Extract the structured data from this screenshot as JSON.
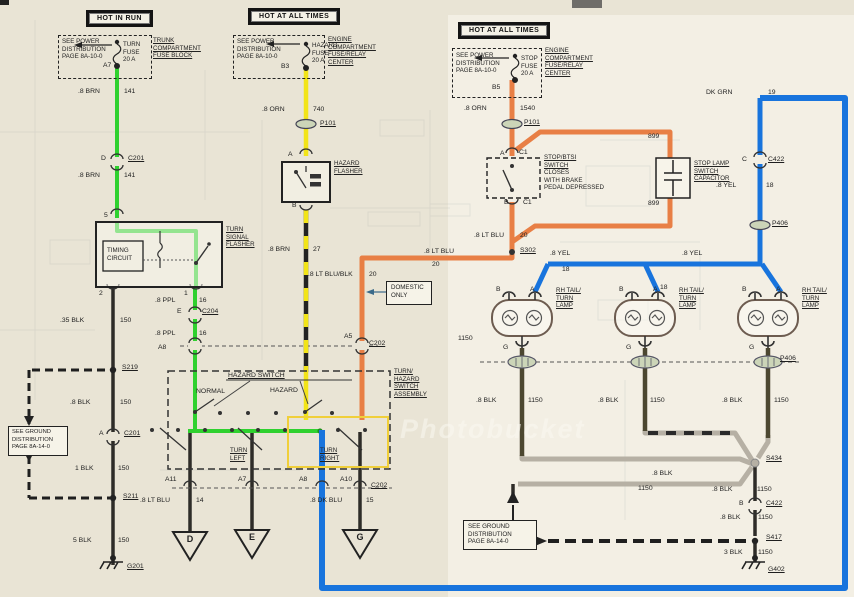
{
  "colors": {
    "green": "#2fd12f",
    "yellow": "#f2e418",
    "orange": "#e87f45",
    "blue": "#1874dd",
    "gray_bus": "#b6b0a4",
    "paper": "#e9e4d5",
    "paper_right": "#f3efe4",
    "wire_dark": "#2e2c28",
    "olive": "#4c4730"
  },
  "watermark": "Photobucket",
  "feeds": [
    {
      "banner": "HOT IN RUN",
      "note": [
        "SEE POWER",
        "DISTRIBUTION",
        "PAGE 8A-10-0"
      ],
      "fuse": [
        "TURN",
        "FUSE",
        "20 A"
      ],
      "loc": [
        "TRUNK",
        "COMPARTMENT",
        "FUSE BLOCK"
      ]
    },
    {
      "banner": "HOT AT ALL TIMES",
      "note": [
        "SEE POWER",
        "DISTRIBUTION",
        "PAGE 8A-10-0"
      ],
      "fuse": [
        "HAZARD",
        "FUSE",
        "20 A"
      ],
      "loc": [
        "ENGINE",
        "COMPARTMENT",
        "FUSE/RELAY",
        "CENTER"
      ]
    },
    {
      "banner": "HOT AT ALL TIMES",
      "note": [
        "SEE POWER",
        "DISTRIBUTION",
        "PAGE 8A-10-0"
      ],
      "fuse": [
        "STOP",
        "FUSE",
        "20 A"
      ],
      "loc": [
        "ENGINE",
        "COMPARTMENT",
        "FUSE/RELAY",
        "CENTER"
      ]
    }
  ],
  "components": {
    "turn_flasher": {
      "name": [
        "TURN",
        "SIGNAL",
        "FLASHER"
      ],
      "timing": [
        "TIMING",
        "CIRCUIT"
      ]
    },
    "hazard_flasher": {
      "name": [
        "HAZARD",
        "FLASHER"
      ]
    },
    "stop_switch": {
      "title": [
        "STOP/BTSI",
        "SWITCH"
      ],
      "desc": [
        "CLOSES",
        "WITH BRAKE",
        "PEDAL DEPRESSED"
      ]
    },
    "capacitor": {
      "name": [
        "STOP LAMP",
        "SWITCH",
        "CAPACITOR"
      ]
    },
    "switch_assembly": {
      "hazard_switch": "HAZARD SWITCH",
      "normal": "NORMAL",
      "hazard": "HAZARD",
      "turn_left": [
        "TURN",
        "LEFT"
      ],
      "turn_right": [
        "TURN",
        "RIGHT"
      ],
      "name": [
        "TURN/",
        "HAZARD",
        "SWITCH",
        "ASSEMBLY"
      ]
    },
    "domestic_note": [
      "DOMESTIC",
      "ONLY"
    ],
    "ground_ref_left": [
      "SEE GROUND",
      "DISTRIBUTION",
      "PAGE 8A-14-0"
    ],
    "ground_ref_mid": [
      "SEE GROUND",
      "DISTRIBUTION",
      "PAGE 8A-14-0"
    ],
    "lamp": {
      "name": [
        "RH TAIL/",
        "TURN",
        "LAMP"
      ]
    }
  },
  "connector_triangles": [
    "D",
    "E",
    "G"
  ],
  "labels": [
    {
      "t": ".8 BRN",
      "x": 78,
      "y": 88
    },
    {
      "t": "141",
      "x": 124,
      "y": 88
    },
    {
      "t": "A7",
      "x": 103,
      "y": 62
    },
    {
      "t": "D",
      "x": 101,
      "y": 155
    },
    {
      "t": "C201",
      "x": 128,
      "y": 155,
      "u": 1
    },
    {
      "t": ".8 BRN",
      "x": 78,
      "y": 172
    },
    {
      "t": "141",
      "x": 124,
      "y": 172
    },
    {
      "t": "5",
      "x": 104,
      "y": 212
    },
    {
      "t": "2",
      "x": 99,
      "y": 290
    },
    {
      "t": "1",
      "x": 184,
      "y": 290
    },
    {
      "t": ".35 BLK",
      "x": 60,
      "y": 317
    },
    {
      "t": "150",
      "x": 120,
      "y": 317
    },
    {
      "t": "S219",
      "x": 122,
      "y": 364,
      "u": 1
    },
    {
      "t": ".8 BLK",
      "x": 70,
      "y": 399
    },
    {
      "t": "150",
      "x": 120,
      "y": 399
    },
    {
      "t": "A",
      "x": 99,
      "y": 430
    },
    {
      "t": "C201",
      "x": 124,
      "y": 430,
      "u": 1
    },
    {
      "t": "1 BLK",
      "x": 75,
      "y": 465
    },
    {
      "t": "150",
      "x": 118,
      "y": 465
    },
    {
      "t": "S211",
      "x": 123,
      "y": 493,
      "u": 1
    },
    {
      "t": "5 BLK",
      "x": 73,
      "y": 537
    },
    {
      "t": "150",
      "x": 118,
      "y": 537
    },
    {
      "t": "G201",
      "x": 127,
      "y": 563,
      "u": 1
    },
    {
      "t": ".8 PPL",
      "x": 155,
      "y": 297
    },
    {
      "t": "16",
      "x": 199,
      "y": 297
    },
    {
      "t": "E",
      "x": 177,
      "y": 308
    },
    {
      "t": "C204",
      "x": 202,
      "y": 308,
      "u": 1
    },
    {
      "t": ".8 PPL",
      "x": 155,
      "y": 330
    },
    {
      "t": "16",
      "x": 199,
      "y": 330
    },
    {
      "t": "A8",
      "x": 158,
      "y": 344
    },
    {
      "t": "A5",
      "x": 344,
      "y": 333
    },
    {
      "t": "C202",
      "x": 369,
      "y": 340,
      "u": 1
    },
    {
      "t": "B3",
      "x": 281,
      "y": 63
    },
    {
      "t": ".8 ORN",
      "x": 262,
      "y": 106
    },
    {
      "t": "740",
      "x": 313,
      "y": 106
    },
    {
      "t": "P101",
      "x": 320,
      "y": 120,
      "u": 1
    },
    {
      "t": "A",
      "x": 288,
      "y": 151
    },
    {
      "t": "B",
      "x": 292,
      "y": 202
    },
    {
      "t": ".8 BRN",
      "x": 268,
      "y": 246
    },
    {
      "t": "27",
      "x": 313,
      "y": 246
    },
    {
      "t": ".8 LT BLU/BLK",
      "x": 308,
      "y": 271
    },
    {
      "t": "20",
      "x": 369,
      "y": 271
    },
    {
      "t": "B5",
      "x": 492,
      "y": 84
    },
    {
      "t": ".8 ORN",
      "x": 464,
      "y": 105
    },
    {
      "t": "1540",
      "x": 520,
      "y": 105
    },
    {
      "t": "P101",
      "x": 524,
      "y": 119,
      "u": 1
    },
    {
      "t": "A",
      "x": 500,
      "y": 150
    },
    {
      "t": "C1",
      "x": 519,
      "y": 149
    },
    {
      "t": "B",
      "x": 504,
      "y": 199
    },
    {
      "t": "C1",
      "x": 523,
      "y": 199
    },
    {
      "t": ".8 LT BLU",
      "x": 474,
      "y": 232
    },
    {
      "t": "20",
      "x": 520,
      "y": 232
    },
    {
      "t": "S302",
      "x": 520,
      "y": 247,
      "u": 1
    },
    {
      "t": ".8 LT BLU",
      "x": 424,
      "y": 248
    },
    {
      "t": "20",
      "x": 432,
      "y": 261
    },
    {
      "t": "899",
      "x": 648,
      "y": 133
    },
    {
      "t": "899",
      "x": 648,
      "y": 200
    },
    {
      "t": "DK GRN",
      "x": 706,
      "y": 89
    },
    {
      "t": "19",
      "x": 768,
      "y": 89
    },
    {
      "t": "C",
      "x": 742,
      "y": 156
    },
    {
      "t": "C422",
      "x": 768,
      "y": 156,
      "u": 1
    },
    {
      "t": ".8 YEL",
      "x": 716,
      "y": 182
    },
    {
      "t": "18",
      "x": 766,
      "y": 182
    },
    {
      "t": "P406",
      "x": 772,
      "y": 220,
      "u": 1
    },
    {
      "t": ".8 YEL",
      "x": 550,
      "y": 250
    },
    {
      "t": "18",
      "x": 562,
      "y": 266
    },
    {
      "t": ".8 YEL",
      "x": 682,
      "y": 250
    },
    {
      "t": "18",
      "x": 660,
      "y": 284
    },
    {
      "t": "1150",
      "x": 458,
      "y": 335
    },
    {
      "t": "B",
      "x": 496,
      "y": 286
    },
    {
      "t": "A",
      "x": 530,
      "y": 286
    },
    {
      "t": "G",
      "x": 503,
      "y": 344
    },
    {
      "t": "B",
      "x": 619,
      "y": 286
    },
    {
      "t": "A",
      "x": 653,
      "y": 286
    },
    {
      "t": "G",
      "x": 626,
      "y": 344
    },
    {
      "t": "B",
      "x": 742,
      "y": 286
    },
    {
      "t": "A",
      "x": 776,
      "y": 286
    },
    {
      "t": "G",
      "x": 749,
      "y": 344
    },
    {
      "t": "P406",
      "x": 780,
      "y": 355,
      "u": 1
    },
    {
      "t": ".8 BLK",
      "x": 476,
      "y": 397
    },
    {
      "t": "1150",
      "x": 528,
      "y": 397
    },
    {
      "t": ".8 BLK",
      "x": 598,
      "y": 397
    },
    {
      "t": "1150",
      "x": 650,
      "y": 397
    },
    {
      "t": ".8 BLK",
      "x": 722,
      "y": 397
    },
    {
      "t": "1150",
      "x": 774,
      "y": 397
    },
    {
      "t": "S434",
      "x": 766,
      "y": 455,
      "u": 1
    },
    {
      "t": ".8 BLK",
      "x": 652,
      "y": 470
    },
    {
      "t": "1150",
      "x": 638,
      "y": 485
    },
    {
      "t": ".8 BLK",
      "x": 712,
      "y": 486
    },
    {
      "t": "1150",
      "x": 757,
      "y": 486
    },
    {
      "t": "B",
      "x": 739,
      "y": 500
    },
    {
      "t": "C422",
      "x": 766,
      "y": 500,
      "u": 1
    },
    {
      "t": ".8 BLK",
      "x": 720,
      "y": 514
    },
    {
      "t": "1150",
      "x": 758,
      "y": 514
    },
    {
      "t": "S417",
      "x": 766,
      "y": 534,
      "u": 1
    },
    {
      "t": "3 BLK",
      "x": 724,
      "y": 549
    },
    {
      "t": "1150",
      "x": 758,
      "y": 549
    },
    {
      "t": "G402",
      "x": 768,
      "y": 566,
      "u": 1
    },
    {
      "t": "A11",
      "x": 165,
      "y": 476
    },
    {
      "t": "A7",
      "x": 238,
      "y": 476
    },
    {
      "t": "A8",
      "x": 299,
      "y": 476
    },
    {
      "t": "A10",
      "x": 340,
      "y": 476
    },
    {
      "t": "C202",
      "x": 371,
      "y": 482,
      "u": 1
    },
    {
      "t": ".8 LT BLU",
      "x": 140,
      "y": 497
    },
    {
      "t": "14",
      "x": 196,
      "y": 497
    },
    {
      "t": ".8 DK BLU",
      "x": 310,
      "y": 497
    },
    {
      "t": "15",
      "x": 366,
      "y": 497
    }
  ]
}
